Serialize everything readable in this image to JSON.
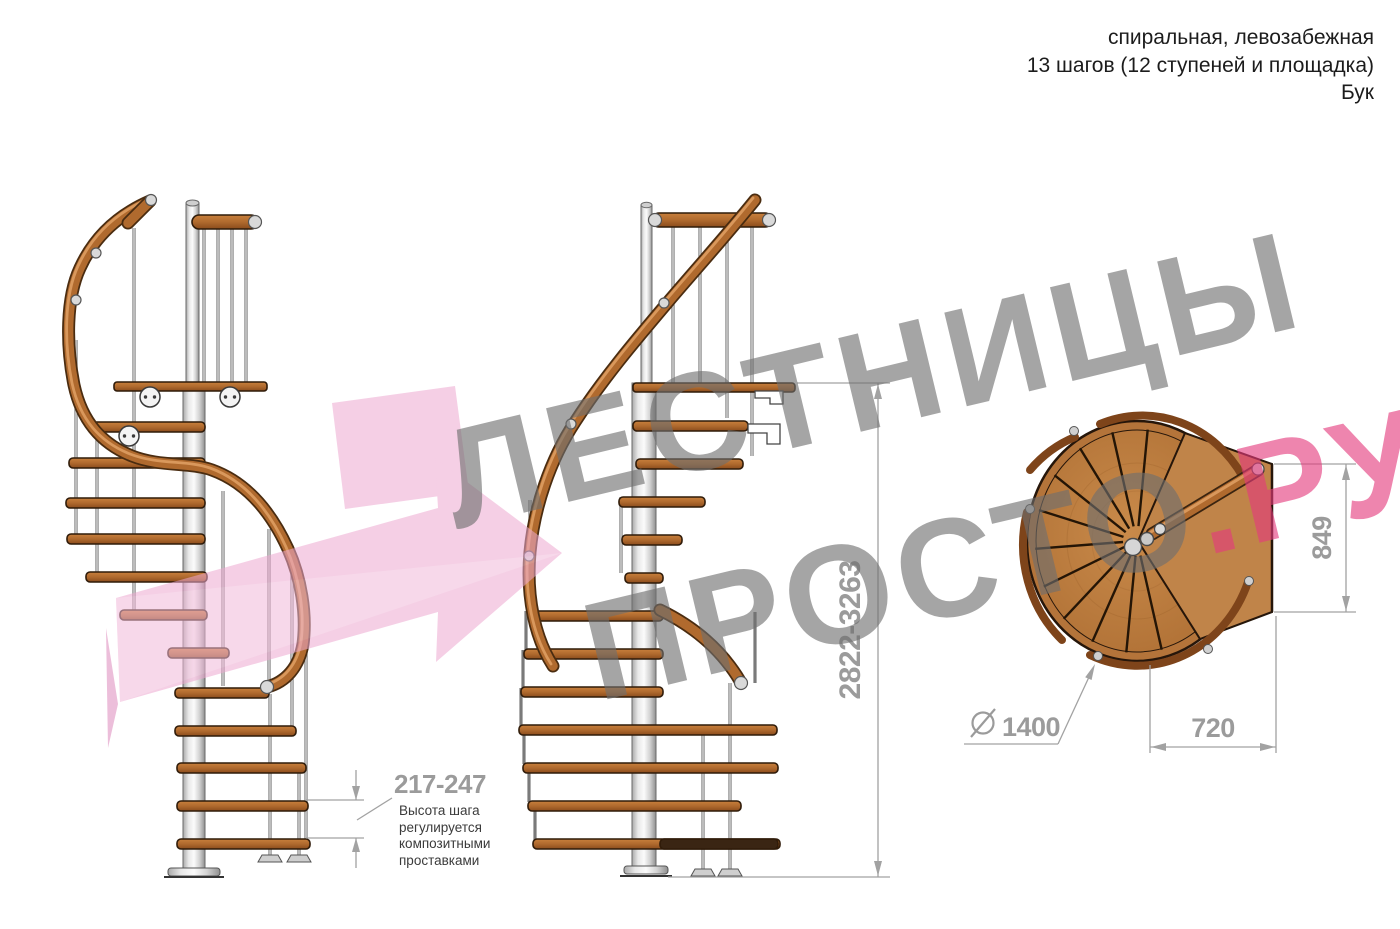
{
  "header": {
    "type_line": "спиральная, левозабежная",
    "steps_line": "13 шагов (12 ступеней и площадка)",
    "material_line": "Бук"
  },
  "watermark": {
    "word1": "ЛЕСТНИЦЫ",
    "word2": "ПРОСТО",
    "accent": ".РУ"
  },
  "dimensions": {
    "step_height": "217-247",
    "step_height_note": "Высота шага регулируется композитными проставками",
    "total_height": "2822-3263",
    "diameter_symbol": "⌀",
    "diameter": "1400",
    "landing_width": "720",
    "landing_depth": "849"
  },
  "colors": {
    "dim_gray": "#9b9b9b",
    "note_text": "#3b3b3b",
    "watermark_gray": "#9c9c9c",
    "watermark_pink": "#e85f97",
    "arrow_pink": "#eda8d0",
    "wood": "#b06a2e",
    "wood_dark_edge": "#2f1b09",
    "metal": "#d9d9d9",
    "background": "#ffffff"
  }
}
